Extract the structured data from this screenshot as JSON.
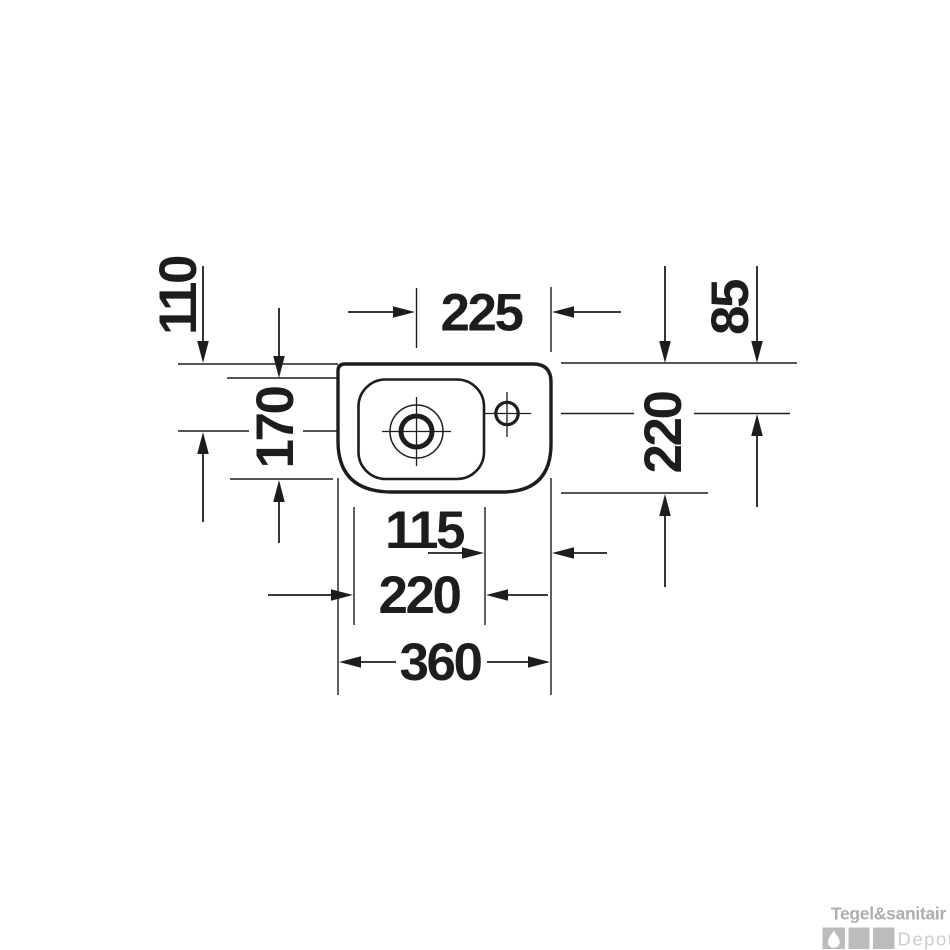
{
  "diagram": {
    "line_color": "#1d1d1b",
    "dimensions": {
      "top_edge_to_drain_center": "110",
      "drain_center_to_right_edge": "225",
      "top_edge_to_tap_center": "85",
      "bowl_depth": "170",
      "overall_depth": "220",
      "tap_platform_width": "115",
      "bowl_width": "220",
      "overall_width": "360"
    }
  },
  "watermark": {
    "brand": "Tegel&sanitair",
    "sub_brand": "Depot",
    "brand_color": "#aeaeae",
    "tile_color": "#bcbcbc",
    "sub_color": "#cccccc"
  }
}
